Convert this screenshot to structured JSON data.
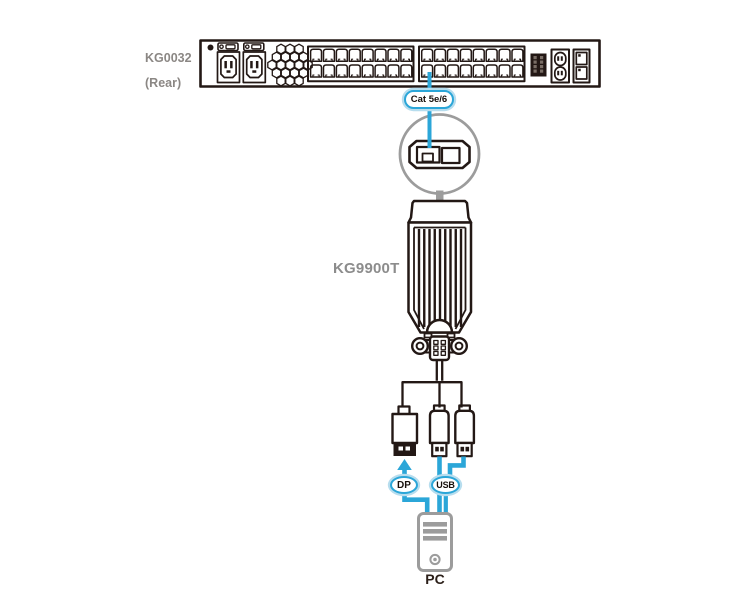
{
  "labels": {
    "switch_model": "KG0032",
    "switch_view": "(Rear)",
    "cable_type": "Cat 5e/6",
    "device_model": "KG9900T",
    "dp_port": "DP",
    "usb_port": "USB",
    "computer": "PC"
  },
  "colors": {
    "accent_blue": "#2BA6D8",
    "accent_blue_halo": "#B7DDEE",
    "line_dark": "#231815",
    "device_gray": "#9C9C9C",
    "label_gray": "#8B8784",
    "pc_label_dark": "#2B1F19"
  }
}
